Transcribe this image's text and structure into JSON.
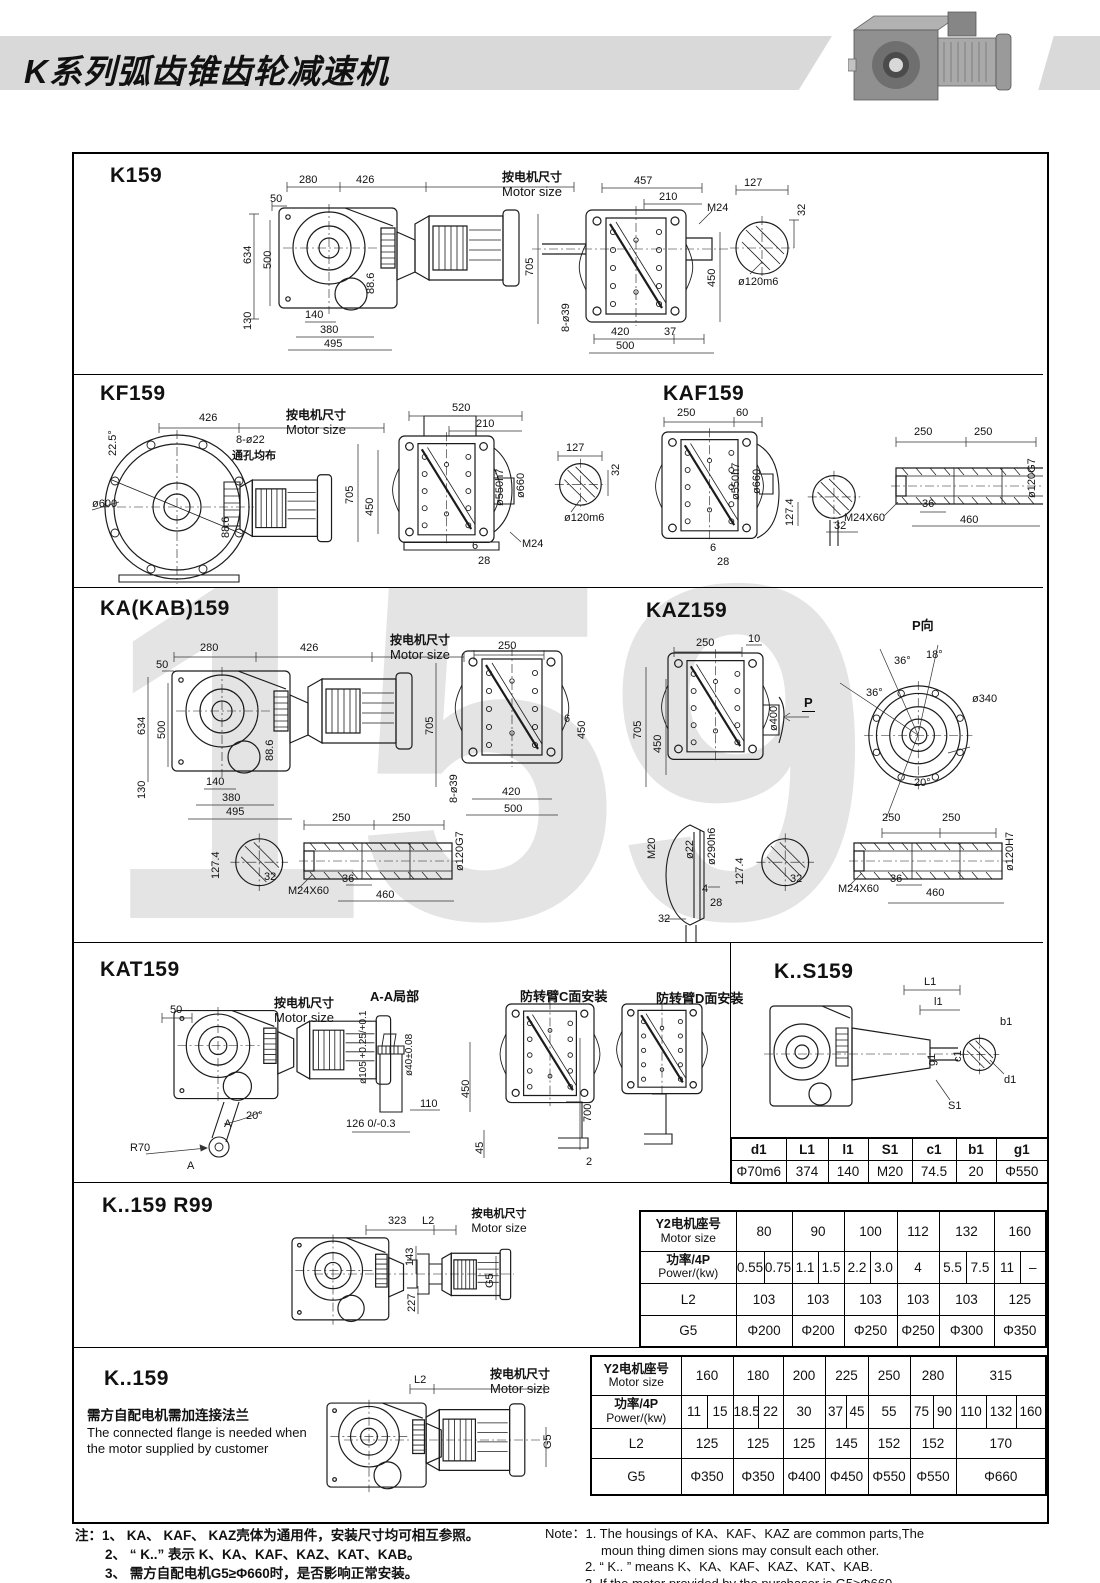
{
  "header": {
    "title": "K系列弧齿锥齿轮减速机"
  },
  "watermark": "159",
  "common": {
    "motor_cn": "按电机尺寸",
    "motor_en": "Motor size",
    "row_labels": {
      "motor_cn": "Y2电机座号",
      "motor_en": "Motor size",
      "power_cn": "功率/4P",
      "power_en": "Power/(kw)",
      "l2": "L2",
      "g5": "G5"
    }
  },
  "sections": {
    "k159": {
      "title": "K159",
      "dims": [
        "280",
        "426",
        "50",
        "634",
        "500",
        "88.6",
        "130",
        "140",
        "380",
        "495",
        "457",
        "210",
        "M24",
        "705",
        "450",
        "8-ø39",
        "420",
        "37",
        "500",
        "127",
        "32",
        "ø120m6"
      ]
    },
    "kf159": {
      "title": "KF159",
      "dims": [
        "426",
        "22.5°",
        "8-ø22",
        "通孔均布",
        "ø600",
        "88.6",
        "520",
        "210",
        "705",
        "450",
        "ø550h7",
        "ø660",
        "6",
        "28",
        "M24",
        "127",
        "32",
        "ø120m6"
      ]
    },
    "kaf159": {
      "title": "KAF159",
      "dims": [
        "250",
        "60",
        "ø550h7",
        "ø660",
        "6",
        "28",
        "127.4",
        "32",
        "250",
        "250",
        "36",
        "460",
        "M24X60",
        "ø120G7"
      ]
    },
    "ka159": {
      "title": "KA(KAB)159",
      "dims": [
        "280",
        "426",
        "50",
        "634",
        "500",
        "88.6",
        "130",
        "140",
        "380",
        "495",
        "250",
        "705",
        "6",
        "450",
        "8-ø39",
        "420",
        "500",
        "127.4",
        "32",
        "250",
        "250",
        "36",
        "460",
        "M24X60",
        "ø120G7"
      ]
    },
    "kaz159": {
      "title": "KAZ159",
      "p_view": "P向",
      "dims": [
        "250",
        "10",
        "705",
        "450",
        "ø400",
        "P",
        "18°",
        "36°",
        "36°",
        "ø340",
        "20°",
        "M20",
        "ø22",
        "ø290h6",
        "4",
        "28",
        "32",
        "127.4",
        "32",
        "250",
        "250",
        "36",
        "460",
        "M24X60",
        "ø120H7"
      ]
    },
    "kat159": {
      "title": "KAT159",
      "aa_label": "A-A局部",
      "c_label": "防转臂C面安装",
      "d_label": "防转臂D面安装",
      "dims": [
        "50",
        "20°",
        "R70",
        "A",
        "A",
        "ø105 +0.25/+0.1",
        "ø40±0.08",
        "110",
        "126 0/-0.3",
        "450",
        "45",
        "700",
        "2"
      ]
    },
    "ks159": {
      "title": "K..S159",
      "dims": [
        "L1",
        "l1",
        "g1",
        "S1",
        "b1",
        "c1",
        "d1"
      ],
      "table": {
        "headers": [
          "d1",
          "L1",
          "l1",
          "S1",
          "c1",
          "b1",
          "g1"
        ],
        "values": [
          "Φ70m6",
          "374",
          "140",
          "M20",
          "74.5",
          "20",
          "Φ550"
        ]
      }
    },
    "r99": {
      "title": "K..159   R99",
      "dims": [
        "323",
        "L2",
        "143",
        "227",
        "G5"
      ]
    },
    "k159b": {
      "title": "K..159",
      "note_cn": "需方自配电机需加连接法兰",
      "note_en1": "The connected flange is needed when",
      "note_en2": "the motor supplied by customer",
      "dims": [
        "L2",
        "G5"
      ]
    }
  },
  "table1": {
    "motor_sizes": [
      "80",
      "90",
      "100",
      "112",
      "132",
      "160"
    ],
    "power": [
      [
        "0.55",
        "0.75"
      ],
      [
        "1.1",
        "1.5"
      ],
      [
        "2.2",
        "3.0"
      ],
      [
        "4"
      ],
      [
        "5.5",
        "7.5"
      ],
      [
        "11",
        "–"
      ]
    ],
    "l2": [
      "103",
      "103",
      "103",
      "103",
      "103",
      "125"
    ],
    "g5": [
      "Φ200",
      "Φ200",
      "Φ250",
      "Φ250",
      "Φ300",
      "Φ350"
    ]
  },
  "table2": {
    "motor_sizes": [
      "160",
      "180",
      "200",
      "225",
      "250",
      "280",
      "315"
    ],
    "power": [
      [
        "11",
        "15"
      ],
      [
        "18.5",
        "22"
      ],
      [
        "30"
      ],
      [
        "37",
        "45"
      ],
      [
        "55"
      ],
      [
        "75",
        "90"
      ],
      [
        "110",
        "132",
        "160"
      ]
    ],
    "l2": [
      "125",
      "125",
      "125",
      "145",
      "152",
      "152",
      "170"
    ],
    "g5": [
      "Φ350",
      "Φ350",
      "Φ400",
      "Φ450",
      "Φ550",
      "Φ550",
      "Φ660"
    ]
  },
  "notes": {
    "cn": [
      "注：1、 KA、 KAF、 KAZ壳体为通用件，安装尺寸均可相互参照。",
      "2、 “ K..” 表示 K、KA、KAF、KAZ、KAT、KAB。",
      "3、 需方自配电机G5≥Φ660时，是否影响正常安装。"
    ],
    "en": [
      "Note：1.  The housings of  KA、KAF、KAZ are common parts,The",
      "moun thing dimen sions may consult each other.",
      "2. “ K.. ”  means K、KA、KAF、KAZ、KAT、KAB.",
      "3.  If the motor provided by the purchaser is G5≥Φ660,",
      "please check if normal installation is influenced."
    ]
  }
}
